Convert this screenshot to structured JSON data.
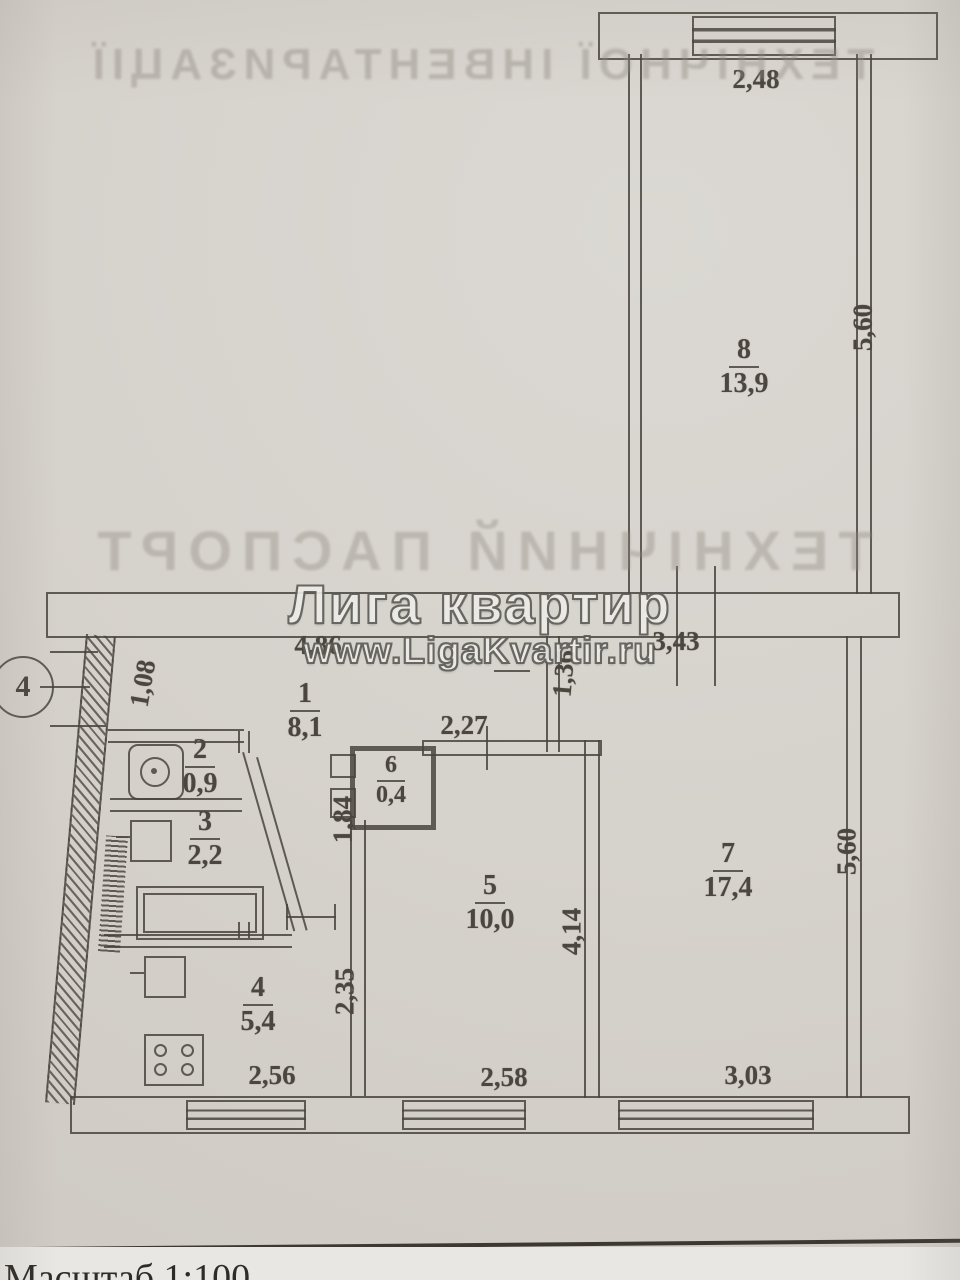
{
  "watermark": {
    "line1": "Лига квартир",
    "line2": "www.LigaKvartir.ru"
  },
  "footer": {
    "scale_label": "Масштаб 1:100"
  },
  "axis": {
    "marker": "4"
  },
  "bleed": {
    "top": "ТЕХНІЧНОЇ ІНВЕНТАРИЗАЦІЇ",
    "middle": "ТЕХНІЧНИЙ ПАСПОРТ"
  },
  "rooms": [
    {
      "number": "1",
      "area": "8,1"
    },
    {
      "number": "2",
      "area": "0,9"
    },
    {
      "number": "3",
      "area": "2,2"
    },
    {
      "number": "4",
      "area": "5,4"
    },
    {
      "number": "5",
      "area": "10,0"
    },
    {
      "number": "6",
      "area": "0,4"
    },
    {
      "number": "7",
      "area": "17,4"
    },
    {
      "number": "8",
      "area": "13,9"
    }
  ],
  "dimensions": {
    "top_window": "2,48",
    "room8_right": "5,60",
    "band_left": "4,86",
    "band_right": "3,43",
    "entry": "1,08",
    "hall_stub": "1,36",
    "room5_top": "2,27",
    "room6_left": "1,84",
    "room5_right": "4,14",
    "room7_right": "5,60",
    "kitchen_right": "2,35",
    "kitchen_window": "2,56",
    "room5_window": "2,58",
    "room7_window": "3,03"
  },
  "colors": {
    "paper": "#d6d2cc",
    "ink": "#49453e",
    "watermark_fill": "#edece8",
    "watermark_outline": "#5d5b55"
  }
}
